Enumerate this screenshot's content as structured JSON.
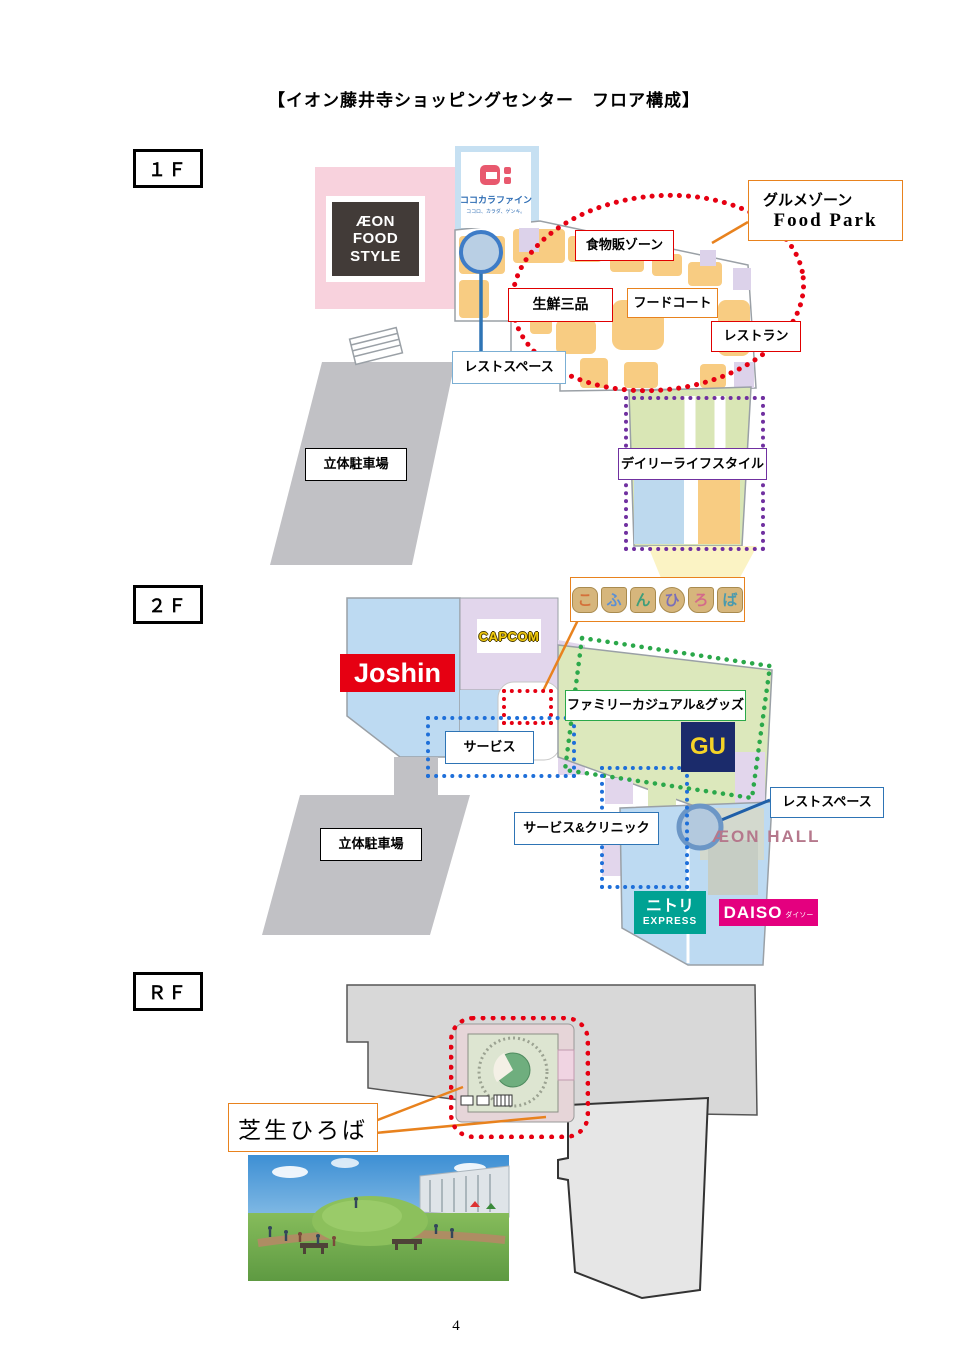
{
  "page": {
    "title": "【イオン藤井寺ショッピングセンター　フロア構成】",
    "page_number": "4"
  },
  "colors": {
    "red_accent": "#E60012",
    "orange_accent": "#E8821E",
    "purple_accent": "#7030A0",
    "green_accent": "#2BA84A",
    "blue_accent": "#1F5FA8",
    "pink_zone": "#F8D2DD",
    "blue_zone": "#BDDAF2",
    "orange_zone": "#F8CC82",
    "green_zone": "#DCE8BC",
    "lavender_zone": "#E2D6EC",
    "parking_gray": "#C1C1C5"
  },
  "floor_1f": {
    "tag": "１Ｆ",
    "aeon_food_style": [
      "ÆON",
      "FOOD",
      "STYLE"
    ],
    "cocokara": {
      "name": "ココカラファイン",
      "tagline": "ココロ、カラダ、ゲンキ。"
    },
    "gourmet_zone": {
      "line1": "グルメゾーン",
      "line2": "Food Park"
    },
    "food_sales_zone": "食物販ゾーン",
    "fresh_three": "生鮮三品",
    "food_court": "フードコート",
    "restaurant": "レストラン",
    "rest_space": "レストスペース",
    "parking": "立体駐車場",
    "daily_lifestyle": "デイリーライフスタイル"
  },
  "floor_2f": {
    "tag": "２Ｆ",
    "kofun_hiroba": [
      "こ",
      "ふ",
      "ん",
      "ひ",
      "ろ",
      "ば"
    ],
    "joshin": "Joshin",
    "capcom": "CAPCOM",
    "gu": "GU",
    "family_casual": "ファミリーカジュアル&グッズ",
    "service": "サービス",
    "service_clinic": "サービス&クリニック",
    "rest_space": "レストスペース",
    "parking": "立体駐車場",
    "aeon_hall": "ÆON HALL",
    "nitori": {
      "name": "ニトリ",
      "sub": "EXPRESS"
    },
    "daiso": {
      "name": "DAISO",
      "sub": "ダイソー"
    }
  },
  "floor_rf": {
    "tag": "ＲＦ",
    "lawn_plaza": "芝生ひろば"
  }
}
